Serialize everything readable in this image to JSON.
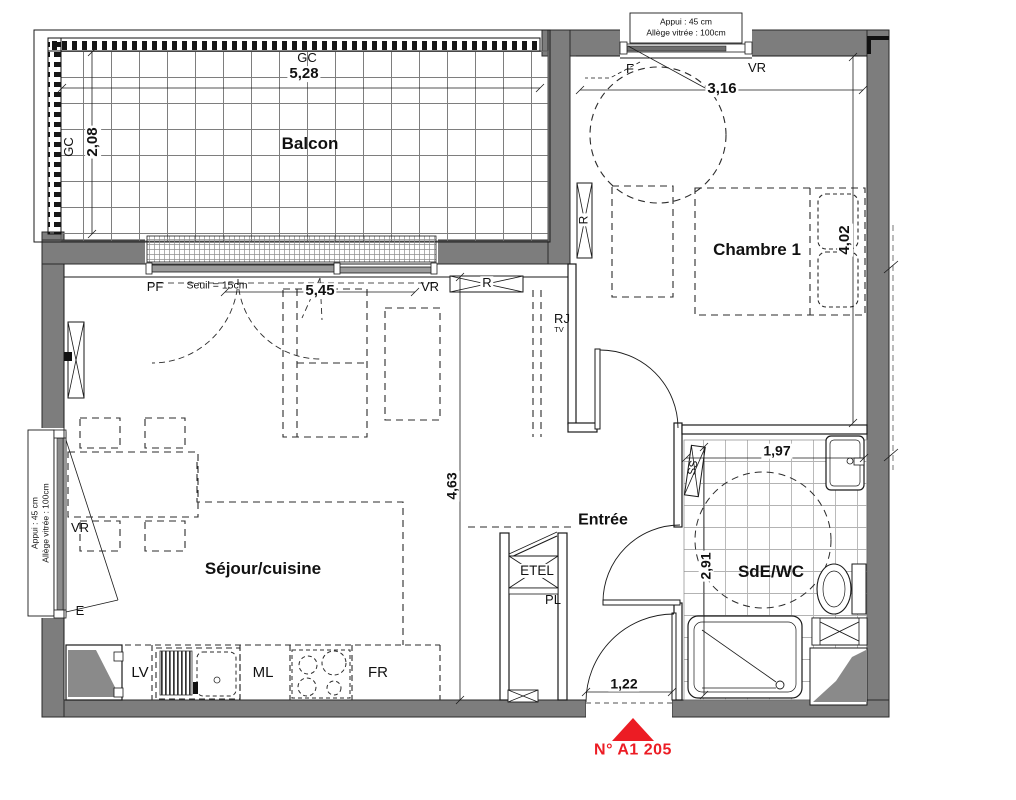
{
  "unit": {
    "number_label": "N° A1 205"
  },
  "colors": {
    "wall_gray": "#7d7d7d",
    "soffit_gray": "#8a8a8a",
    "accent_red": "#ec1c24",
    "line": "#1a1a1a"
  },
  "rooms": {
    "balcony": "Balcon",
    "bedroom": "Chambre 1",
    "living_kitchen": "Séjour/cuisine",
    "entry": "Entrée",
    "bathroom": "SdE/WC"
  },
  "dims": {
    "balcony_width": "5,28",
    "balcony_depth": "2,08",
    "bedroom_width": "3,16",
    "bedroom_depth": "4,02",
    "living_width": "5,45",
    "living_depth": "4,63",
    "bath_width": "1,97",
    "bath_depth": "2,91",
    "entry_door_width": "1,22"
  },
  "labels": {
    "gc": "GC",
    "pf": "PF",
    "seuil": "Seuil = 15cm",
    "vr": "VR",
    "f": "F",
    "e": "E",
    "r": "R",
    "rj": "RJ",
    "tv": "TV",
    "lv": "LV",
    "ml": "ML",
    "fr": "FR",
    "etel": "ETEL",
    "pl": "PL",
    "ss": "SS"
  },
  "window_note": {
    "line1": "Appui : 45 cm",
    "line2": "Allège vitrée : 100cm"
  }
}
